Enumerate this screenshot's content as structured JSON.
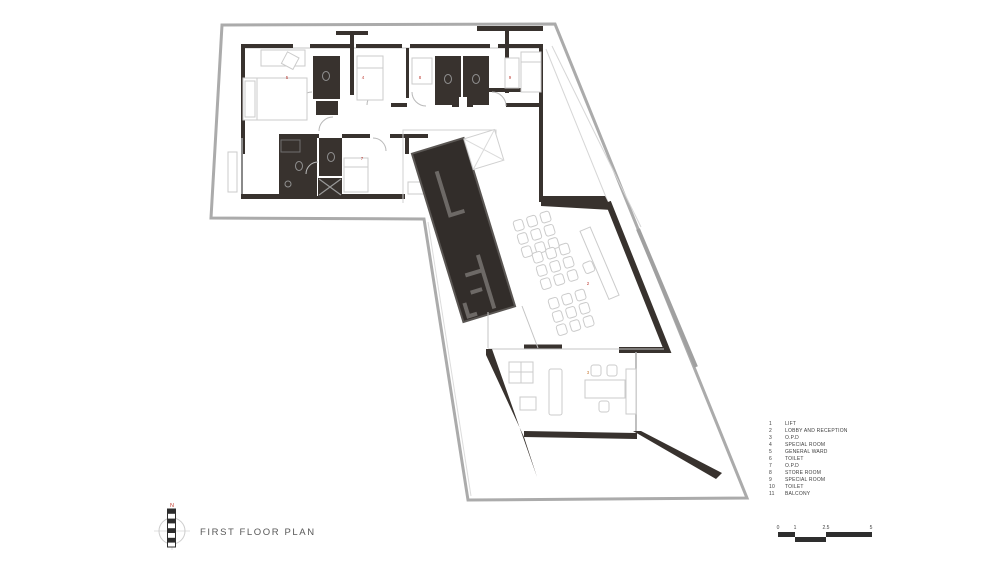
{
  "title_block": {
    "title": "FIRST FLOOR PLAN",
    "north_label": "N"
  },
  "legend": {
    "items": [
      {
        "num": "1",
        "label": "LIFT"
      },
      {
        "num": "2",
        "label": "LOBBY AND RECEPTION"
      },
      {
        "num": "3",
        "label": "O.P.D"
      },
      {
        "num": "4",
        "label": "SPECIAL ROOM"
      },
      {
        "num": "5",
        "label": "GENERAL WARD"
      },
      {
        "num": "6",
        "label": "TOILET"
      },
      {
        "num": "7",
        "label": "O.P.D"
      },
      {
        "num": "8",
        "label": "STORE ROOM"
      },
      {
        "num": "9",
        "label": "SPECIAL ROOM"
      },
      {
        "num": "10",
        "label": "TOILET"
      },
      {
        "num": "11",
        "label": "BALCONY"
      }
    ]
  },
  "scale_bar": {
    "labels": [
      {
        "text": "0",
        "x": 778
      },
      {
        "text": "1",
        "x": 795
      },
      {
        "text": "2.5",
        "x": 826
      },
      {
        "text": "5",
        "x": 871
      }
    ]
  },
  "plan": {
    "room_markers": [
      {
        "num": "5",
        "x": 287,
        "y": 79,
        "color": "#bf4038"
      },
      {
        "num": "4",
        "x": 363,
        "y": 79,
        "color": "#bf4038"
      },
      {
        "num": "8",
        "x": 420,
        "y": 79,
        "color": "#bf4038"
      },
      {
        "num": "9",
        "x": 510,
        "y": 79,
        "color": "#bf4038"
      },
      {
        "num": "7",
        "x": 362,
        "y": 160,
        "color": "#bf4038"
      },
      {
        "num": "2",
        "x": 588,
        "y": 285,
        "color": "#bf4038"
      },
      {
        "num": "3",
        "x": 588,
        "y": 374,
        "color": "#c9803c"
      }
    ],
    "colors": {
      "boundary": "#ababab",
      "wall_dark": "#38322e",
      "core_fill": "#322d2a",
      "core_inner": "#6d6966",
      "furniture": "#cbcbcb",
      "thin": "#c4c4c4",
      "balcony_gray": "#a0a0a0",
      "scale_bar": "#2e2e2e"
    }
  }
}
